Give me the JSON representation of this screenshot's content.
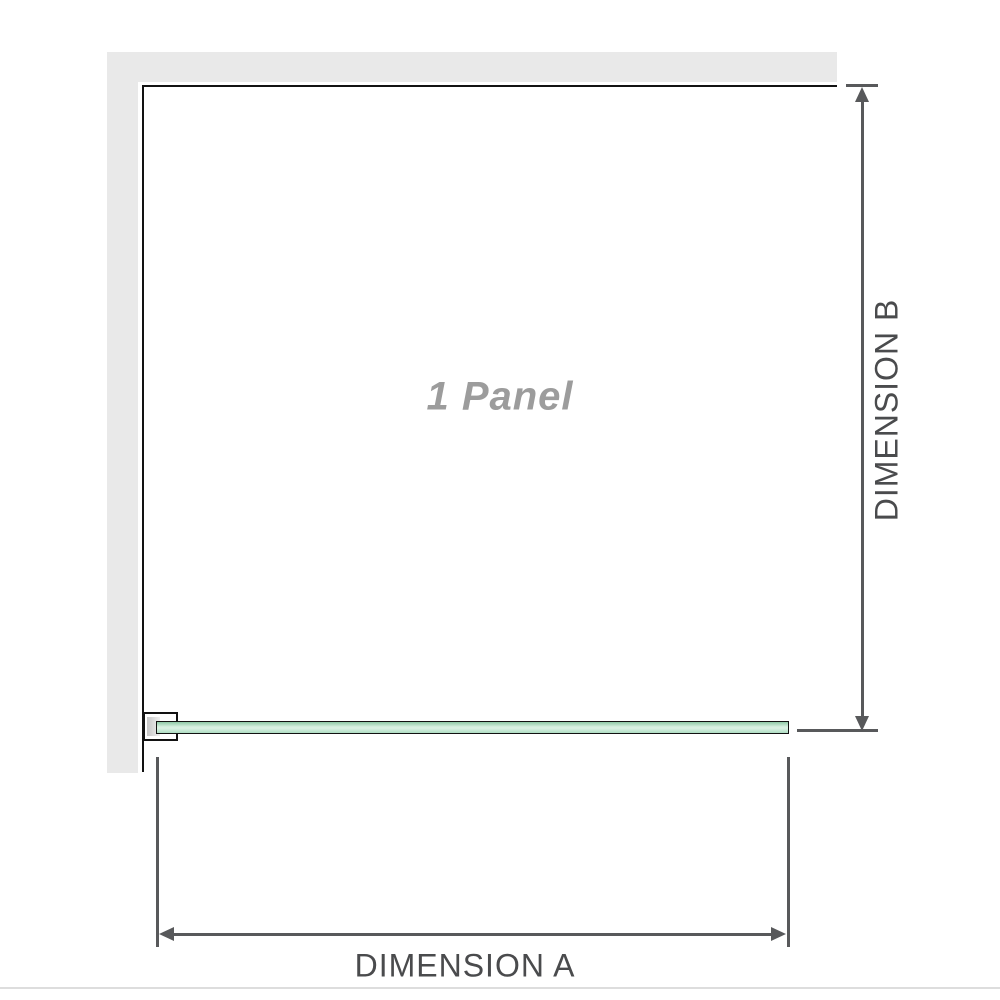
{
  "diagram": {
    "panel_label": "1 Panel",
    "dimension_a_label": "DIMENSION A",
    "dimension_b_label": "DIMENSION B"
  },
  "colors": {
    "wall": "#e9e9e9",
    "outline": "#121212",
    "dimension": "#58595b",
    "dim_text": "#4a4b4d",
    "panel_text": "#9c9c9c",
    "glass_top": "#8fc9a6",
    "glass_light": "#d9f1e2",
    "glass_bottom": "#aeddc2",
    "separator": "#dddddd"
  }
}
